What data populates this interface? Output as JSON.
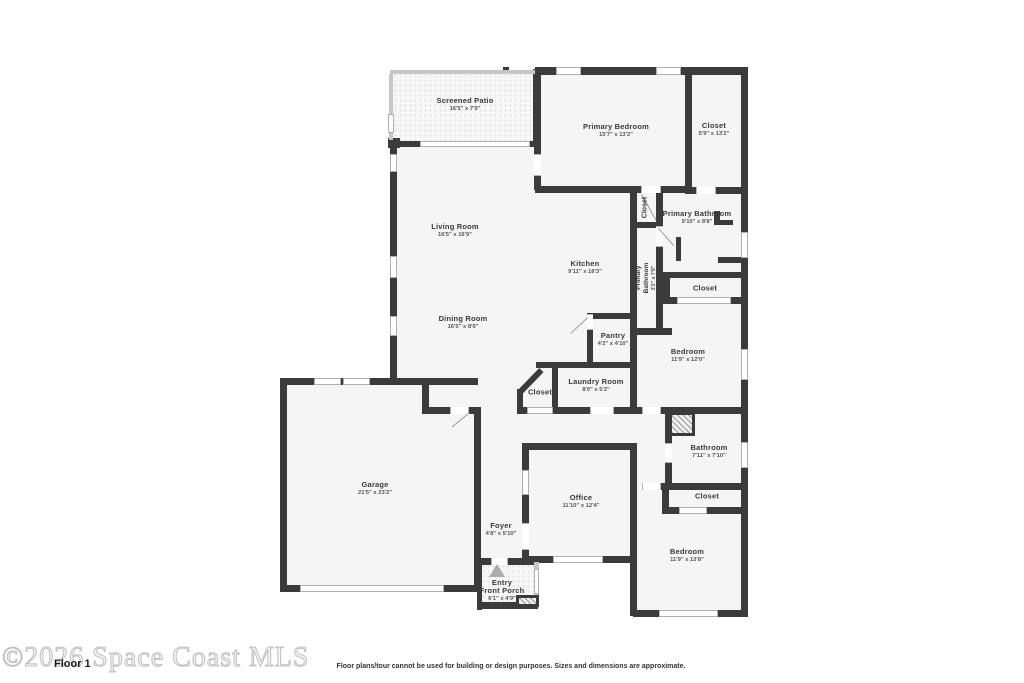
{
  "meta": {
    "watermark": "©2026 Space Coast MLS",
    "floor_label": "Floor 1",
    "disclaimer": "Floor plans/tour cannot be used for building or design purposes. Sizes and dimensions are approximate."
  },
  "colors": {
    "wall": "#3b3b3b",
    "room_fill": "#f5f5f5",
    "screen_wall": "#c6c6c6",
    "window": "#ffffff",
    "watermark": "#c3c3c3",
    "label_text": "#3a3a3a"
  },
  "rooms": [
    {
      "name": "Screened Patio",
      "dims": "16'5\" x 7'9\""
    },
    {
      "name": "Primary Bedroom",
      "dims": "15'7\" x 13'2\""
    },
    {
      "name": "Closet",
      "dims": "5'9\" x 13'2\""
    },
    {
      "name": "Living Room",
      "dims": "16'5\" x 16'9\""
    },
    {
      "name": "Closet",
      "dims": ""
    },
    {
      "name": "Primary Bathroom",
      "dims": "9'10\" x 8'8\""
    },
    {
      "name": "Kitchen",
      "dims": "9'11\" x 18'3\""
    },
    {
      "name": "Primary Bathroom",
      "line1": "Primary",
      "line2": "Bathroom",
      "dims": "3'2\" x 7'8\""
    },
    {
      "name": "Closet",
      "dims": ""
    },
    {
      "name": "Dining Room",
      "dims": "16'5\" x 8'9\""
    },
    {
      "name": "Bedroom",
      "dims": "11'9\" x 12'0\""
    },
    {
      "name": "Pantry",
      "dims": "4'2\" x 4'10\""
    },
    {
      "name": "Laundry Room",
      "dims": "8'0\" x 5'2\""
    },
    {
      "name": "Closet",
      "dims": ""
    },
    {
      "name": "Garage",
      "dims": "21'5\" x 23'2\""
    },
    {
      "name": "Office",
      "dims": "11'10\" x 12'4\""
    },
    {
      "name": "Foyer",
      "dims": "4'8\" x 5'10\""
    },
    {
      "name": "Bathroom",
      "dims": "7'11\" x 7'10\""
    },
    {
      "name": "Closet",
      "dims": ""
    },
    {
      "name": "Bedroom",
      "dims": "11'9\" x 13'8\""
    },
    {
      "name": "Entry",
      "line2": "Front Porch",
      "dims": "6'1\" x 4'9\""
    }
  ]
}
